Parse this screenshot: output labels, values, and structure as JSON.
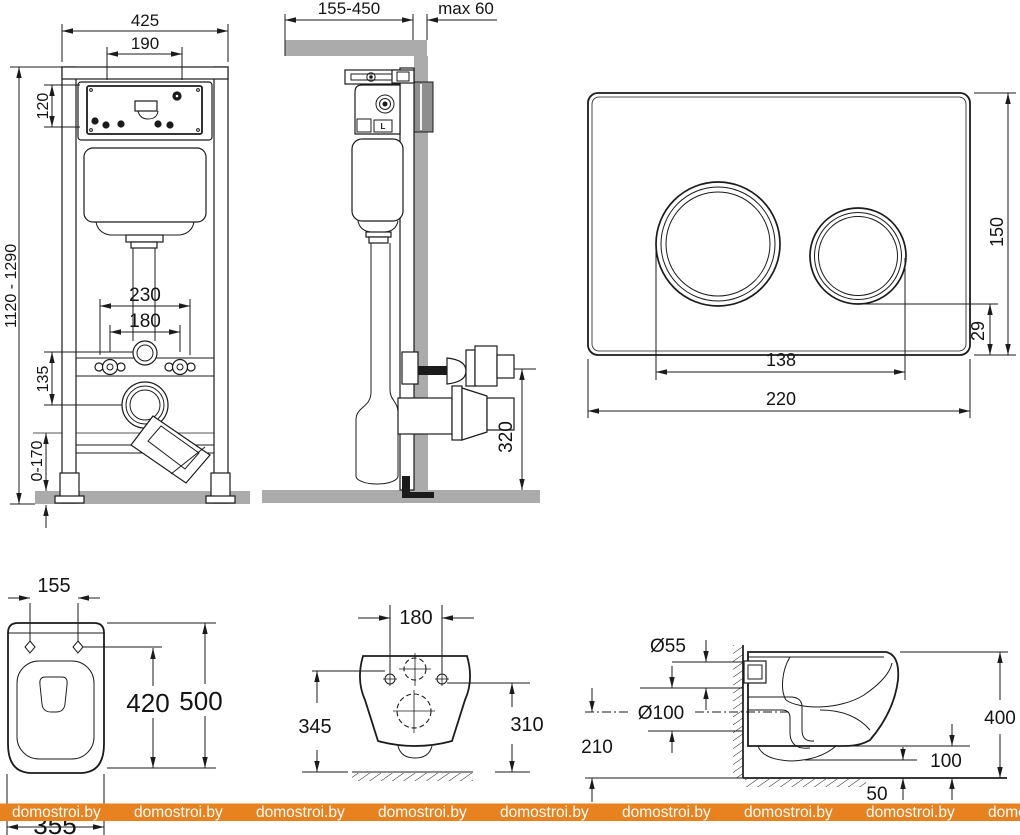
{
  "watermark": {
    "text": "domostroi.by",
    "bar_color": "#e8821e",
    "text_color": "#ffffff"
  },
  "frame_front": {
    "width": "425",
    "panel_width": "190",
    "panel_height": "120",
    "height_range": "1120 - 1290",
    "anchor_spacing": "230",
    "bolt_spacing": "180",
    "drain_drop": "135",
    "leg_range": "0-170"
  },
  "frame_side": {
    "depth_range": "155-450",
    "facing_max": "max 60",
    "drain_height": "320",
    "valve_label": "L"
  },
  "flush_plate": {
    "width": "220",
    "height": "150",
    "buttons_span": "138",
    "bottom_offset": "29"
  },
  "bowl_top": {
    "hole_spacing": "155",
    "depth_to_holes": "420",
    "depth": "500",
    "width": "355"
  },
  "bowl_rear": {
    "bolt_spacing": "180",
    "height_left": "345",
    "height_right": "310"
  },
  "bowl_side": {
    "inlet_d": "Ø55",
    "outlet_d": "Ø100",
    "outlet_axis_height": "210",
    "total_height": "400",
    "clearance": "100",
    "gap": "50"
  }
}
